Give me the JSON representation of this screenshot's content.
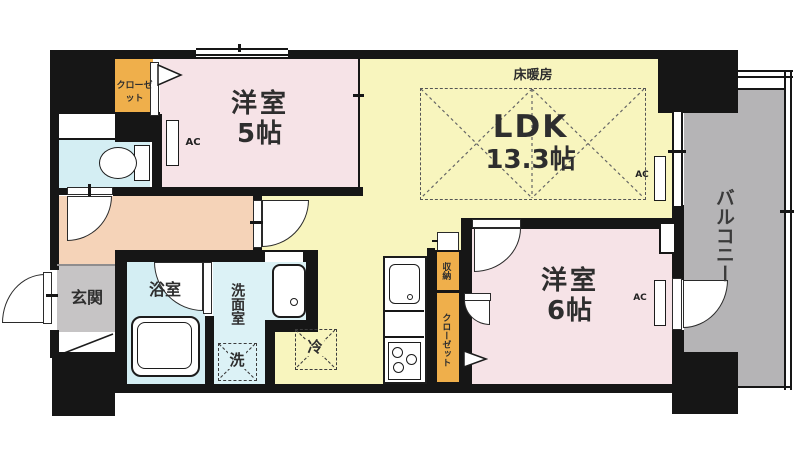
{
  "labels": {
    "room5_name": "洋室",
    "room5_size": "5帖",
    "ldk_name": "LDK",
    "ldk_size": "13.3帖",
    "room6_name": "洋室",
    "room6_size": "6帖",
    "entrance": "玄関",
    "bathroom": "浴室",
    "washroom": "洗面室",
    "balcony": "バルコニー",
    "closet": "クローゼット",
    "storage": "収納",
    "floor_heating": "床暖房",
    "washer": "洗",
    "fridge": "冷",
    "ac": "AC"
  },
  "colors": {
    "wall": "#161616",
    "room_pink": "#F6E3E7",
    "ldk_yellow": "#F8F5BE",
    "hall_peach": "#F5D3B8",
    "entrance_gray": "#C6C4C5",
    "balcony_gray": "#B5B4B6",
    "wet_cyan": "#D4EEF3",
    "closet_orange": "#EFAF4B"
  }
}
